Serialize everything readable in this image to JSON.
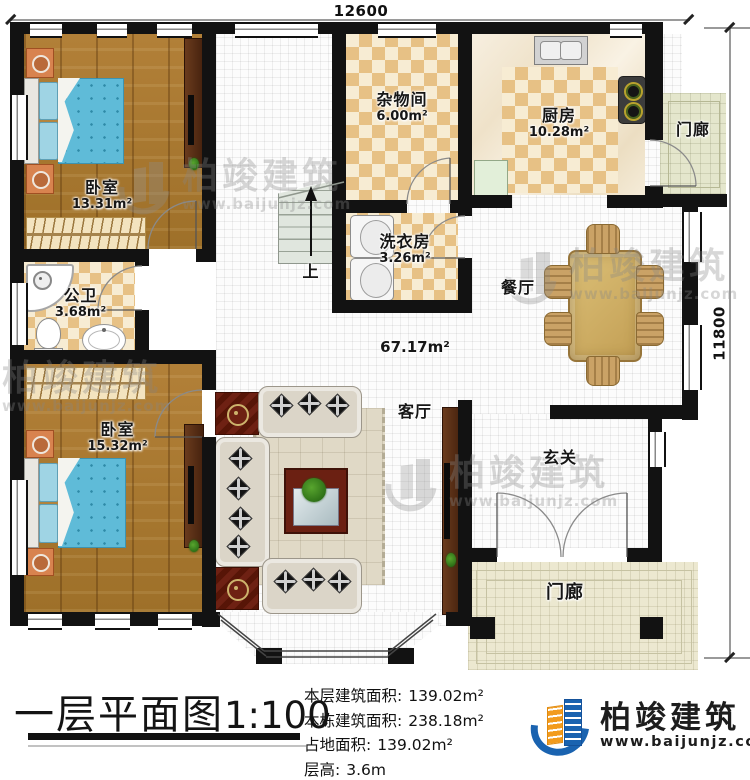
{
  "dimensions": {
    "top": "12600",
    "right": "11800"
  },
  "rooms": {
    "bedroom1": {
      "name": "卧室",
      "area": "13.31m²"
    },
    "storage": {
      "name": "杂物间",
      "area": "6.00m²"
    },
    "kitchen": {
      "name": "厨房",
      "area": "10.28m²"
    },
    "porch_top": {
      "name": "门廊"
    },
    "laundry": {
      "name": "洗衣房",
      "area": "3.26m²"
    },
    "dining": {
      "name": "餐厅"
    },
    "bathroom": {
      "name": "公卫",
      "area": "3.68m²"
    },
    "bedroom2": {
      "name": "卧室",
      "area": "15.32m²"
    },
    "living": {
      "name": "客厅"
    },
    "foyer": {
      "name": "玄关"
    },
    "porch_bottom": {
      "name": "门廊"
    },
    "stairs": {
      "label": "上"
    },
    "open_area": {
      "area": "67.17m²"
    }
  },
  "footer": {
    "title": "一层平面图",
    "scale": "1:100",
    "stats": [
      {
        "label": "本层建筑面积:",
        "value": "139.02m²"
      },
      {
        "label": "本栋建筑面积:",
        "value": "238.18m²"
      },
      {
        "label": "占地面积:",
        "value": "139.02m²"
      },
      {
        "label": "层高:",
        "value": "3.6m"
      }
    ],
    "logo": {
      "name": "柏竣建筑",
      "website": "www.baijunjz.com"
    }
  },
  "watermark": {
    "name": "柏竣建筑",
    "website": "www.baijunjz.com"
  },
  "colors": {
    "wall": "#121212",
    "wood_floor": "#aa7a30",
    "tile_tan": "#e7c185",
    "bed_blue": "#5fbbd8",
    "logo_blue": "#1a63b0",
    "logo_orange": "#f29b1d"
  }
}
